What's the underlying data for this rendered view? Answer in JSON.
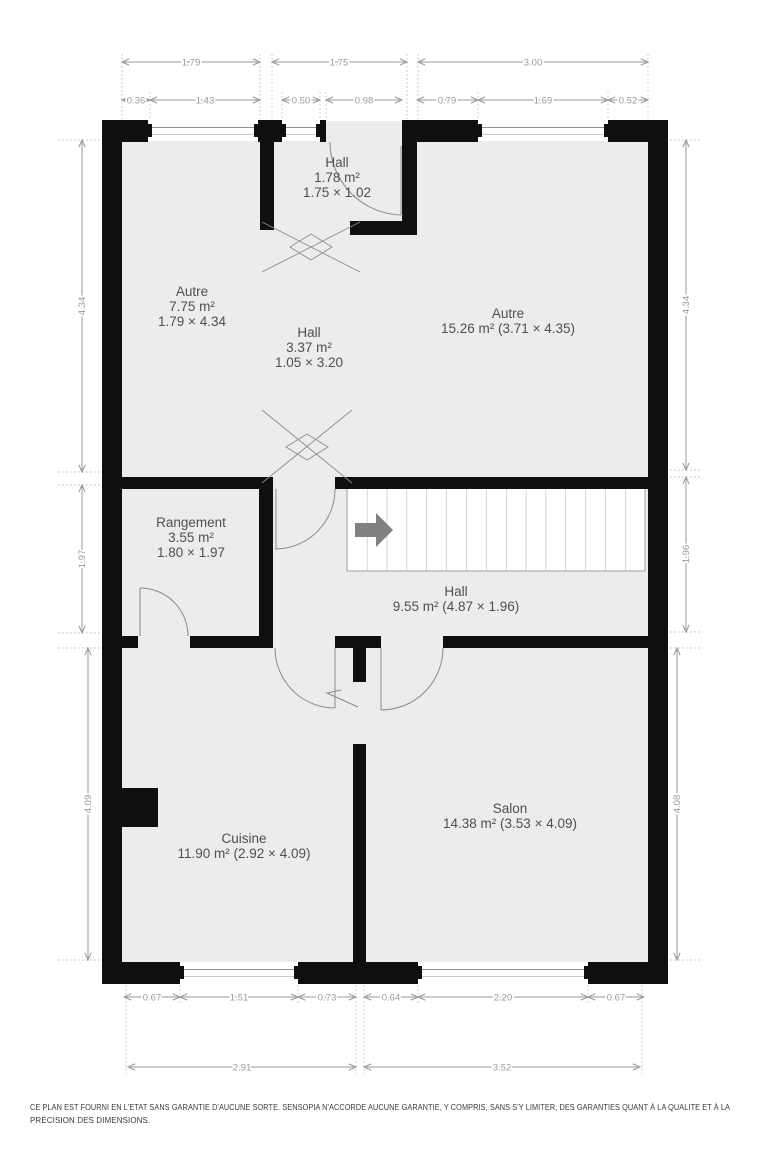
{
  "rooms": {
    "hall_top": {
      "name": "Hall",
      "area": "1.78 m²",
      "dims": "1.75 × 1.02"
    },
    "autre_left": {
      "name": "Autre",
      "area": "7.75 m²",
      "dims": "1.79 × 4.34"
    },
    "hall_mid": {
      "name": "Hall",
      "area": "3.37 m²",
      "dims": "1.05 × 3.20"
    },
    "autre_right": {
      "name": "Autre",
      "area": "15.26 m² (3.71 × 4.35)"
    },
    "rangement": {
      "name": "Rangement",
      "area": "3.55 m²",
      "dims": "1.80 × 1.97"
    },
    "hall_stairs": {
      "name": "Hall",
      "area": "9.55 m² (4.87 × 1.96)"
    },
    "cuisine": {
      "name": "Cuisine",
      "area": "11.90 m² (2.92 × 4.09)"
    },
    "salon": {
      "name": "Salon",
      "area": "14.38 m² (3.53 × 4.09)"
    }
  },
  "dimensions": {
    "top_row1": [
      "1.79",
      "1.75",
      "3.00"
    ],
    "top_row2": [
      "0.36",
      "1.43",
      "0.50",
      "0.98",
      "0.79",
      "1.69",
      "0.52"
    ],
    "left": [
      "4.34",
      "1.97",
      "4.09"
    ],
    "right": [
      "4.34",
      "1.96",
      "4.08"
    ],
    "bottom_row1": [
      "0.67",
      "1.51",
      "0.73",
      "0.64",
      "2.20",
      "0.67"
    ],
    "bottom_row2": [
      "2.91",
      "3.52"
    ]
  },
  "footer": {
    "line1": "CE PLAN EST FOURNI EN L'ETAT SANS GARANTIE D'AUCUNE SORTE. SENSOPIA N'ACCORDE AUCUNE GARANTIE, Y COMPRIS, SANS S'Y LIMITER, DES GARANTIES QUANT À LA QUALITE ET À LA",
    "line2": "PRÉCISION DES DIMENSIONS."
  },
  "colors": {
    "wall": "#0f0f0f",
    "floor": "#ececec",
    "dim": "#9a9a9a",
    "roomlbl": "#4f4f4f",
    "arrow": "#808080",
    "door": "#8a8a8a",
    "footer": "#3a3a3a"
  }
}
